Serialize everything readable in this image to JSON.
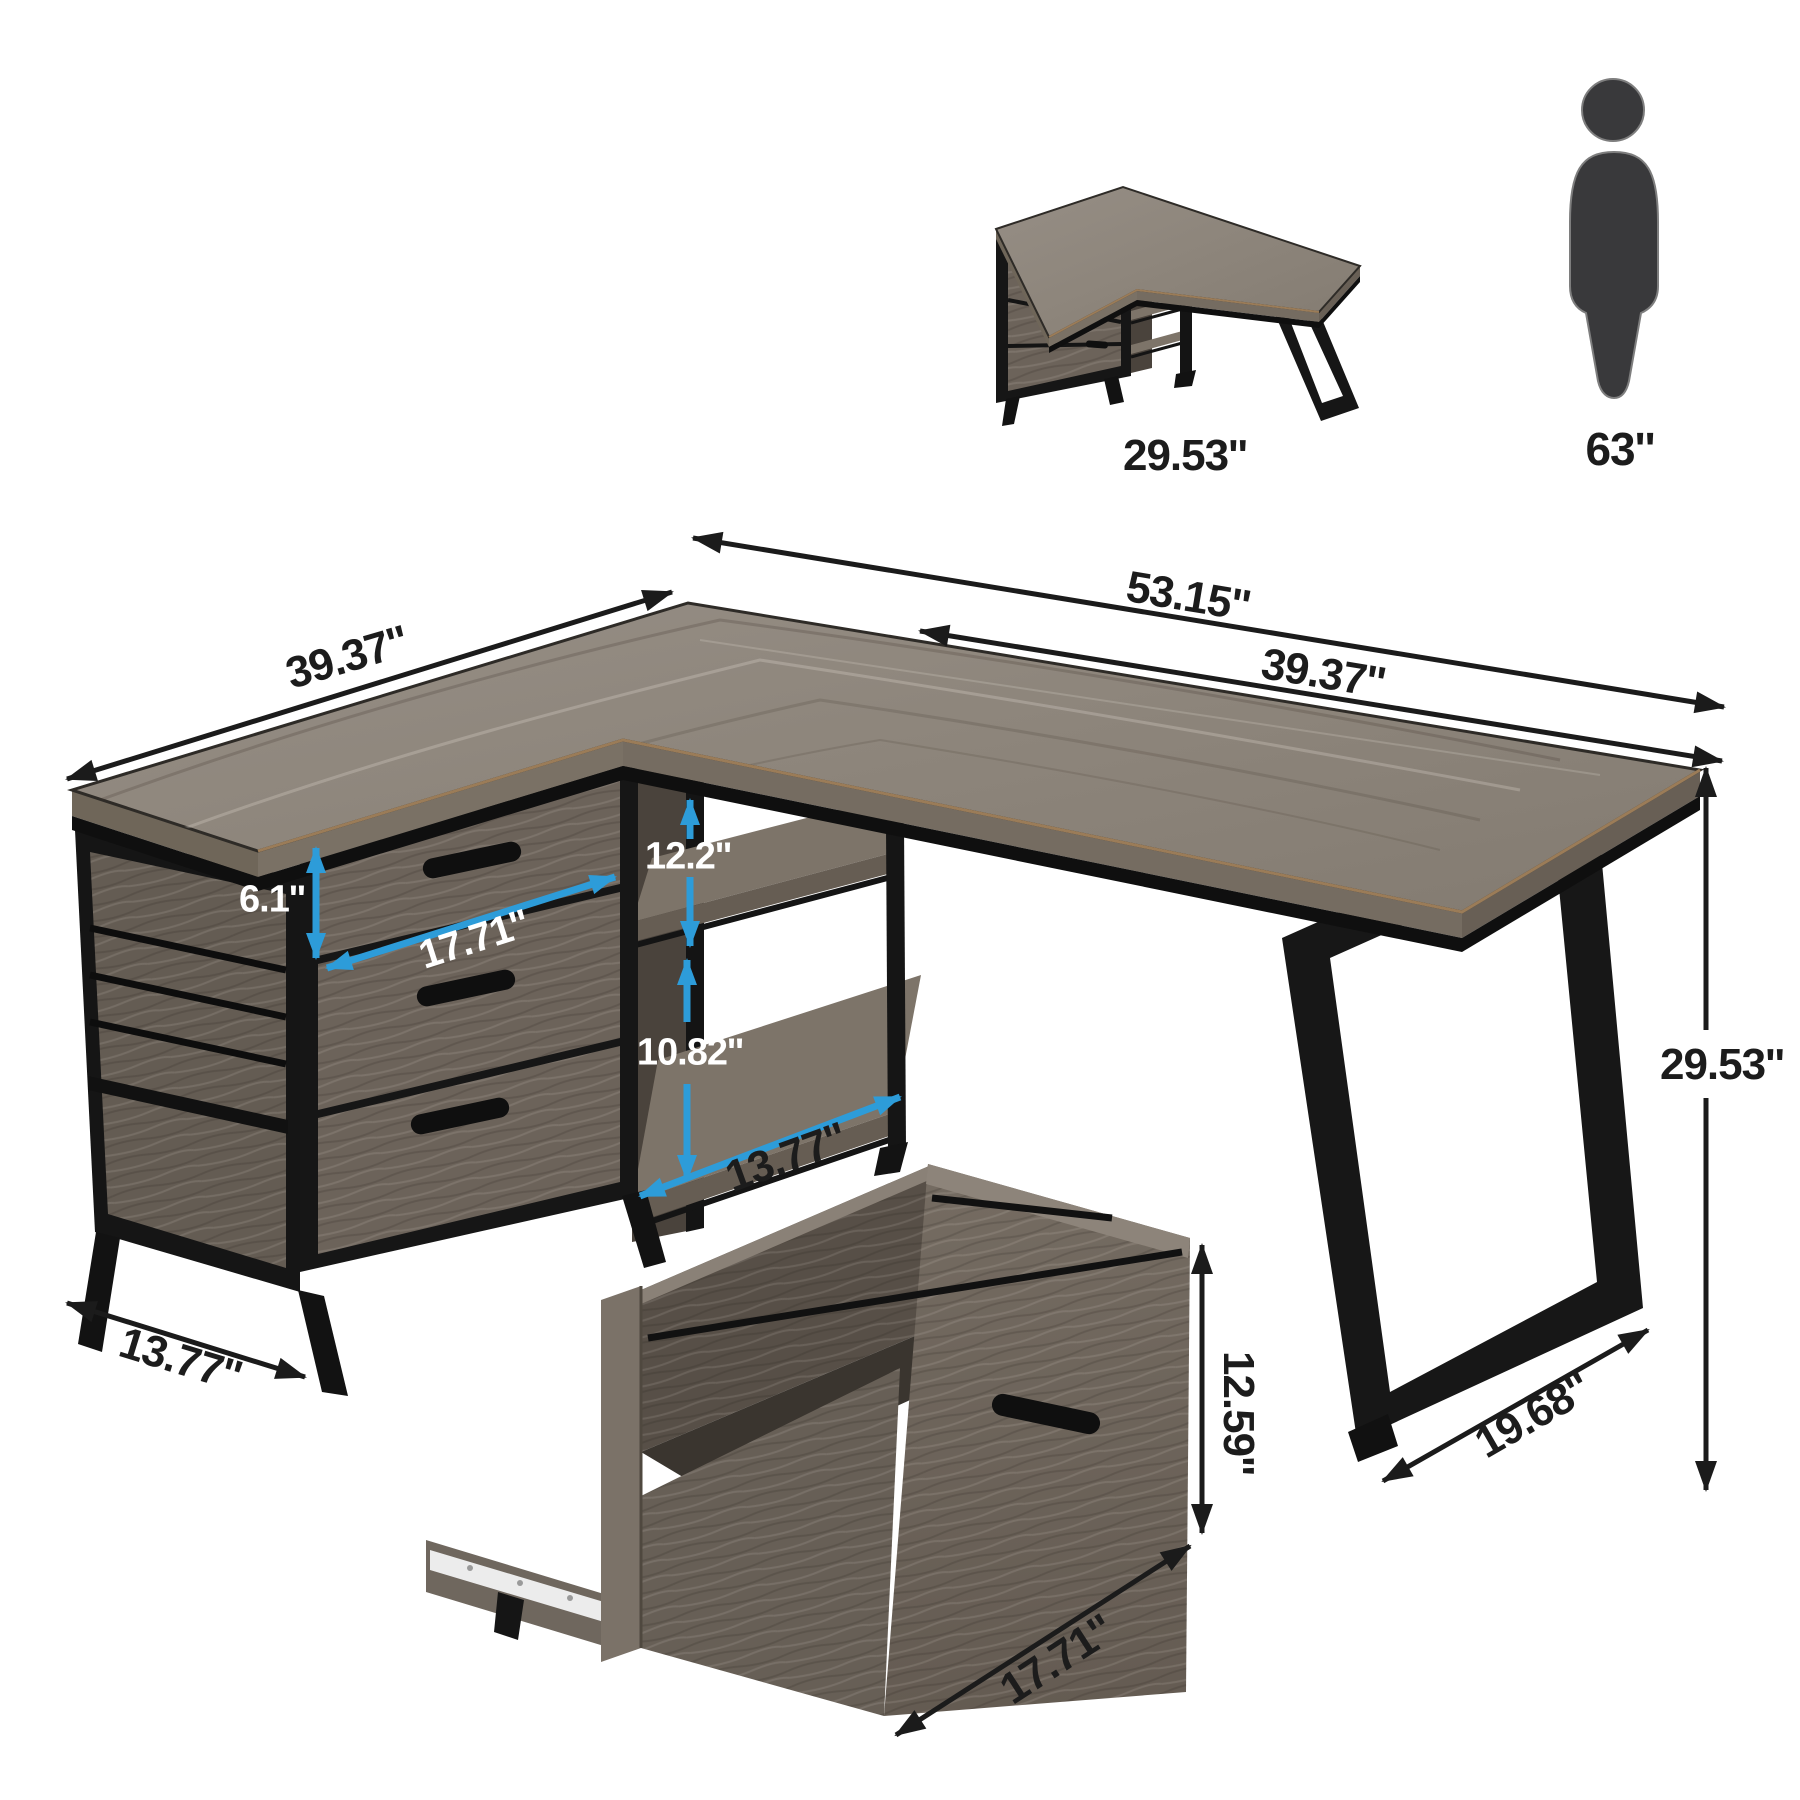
{
  "diagram_type": "furniture-dimension-diagram",
  "product": "L-shaped desk with file cabinet and shelves",
  "inset": {
    "caption": "29.53''"
  },
  "person": {
    "label": "63''"
  },
  "dims": {
    "total_width": "53.15''",
    "right_wing_width": "39.37''",
    "left_wing_width": "39.37''",
    "top_drawer_height": "6.1''",
    "drawer_front_width": "17.71''",
    "upper_shelf_height": "12.2''",
    "lower_shelf_height": "10.82''",
    "shelf_depth": "13.77''",
    "cabinet_depth": "13.77''",
    "desk_height": "29.53''",
    "leg_depth": "19.68''",
    "drawer_box_height": "12.59''",
    "drawer_box_width": "17.71''"
  },
  "colors": {
    "background": "#ffffff",
    "dimension_black": "#1b1b1b",
    "dimension_blue": "#2d9cd9",
    "label_white": "#ffffff",
    "wood_top": "#8d857b",
    "wood_dark": "#574f47",
    "metal_black": "#161616",
    "person_gray": "#39393b"
  }
}
